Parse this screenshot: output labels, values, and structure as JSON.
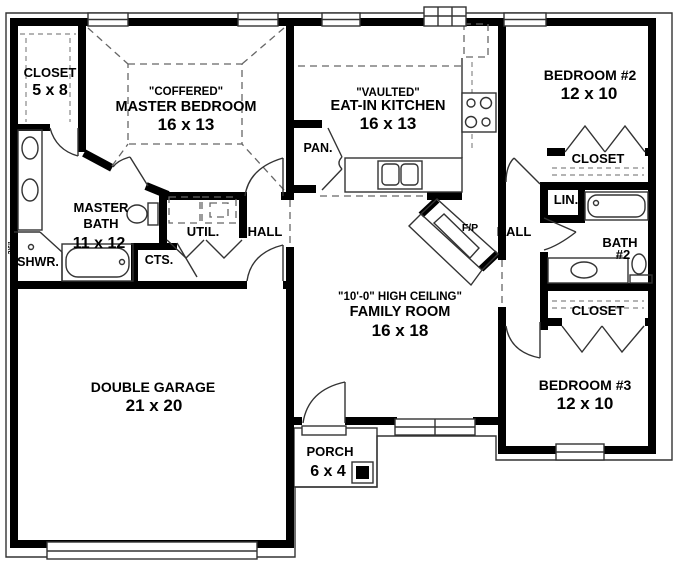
{
  "colors": {
    "walls": "#000000",
    "thin_lines": "#333333",
    "dashed_lines": "#777777",
    "background": "#ffffff"
  },
  "rooms": {
    "master_closet": {
      "name": "CLOSET",
      "dims": "5 x 8"
    },
    "master_bedroom": {
      "ceiling": "\"COFFERED\"",
      "name": "MASTER BEDROOM",
      "dims": "16 x 13"
    },
    "kitchen": {
      "ceiling": "\"VAULTED\"",
      "name": "EAT-IN KITCHEN",
      "dims": "16 x 13"
    },
    "bedroom_2": {
      "name": "BEDROOM #2",
      "dims": "12 x 10"
    },
    "bedroom_2_closet": {
      "name": "CLOSET"
    },
    "linen": {
      "name": "LIN."
    },
    "bath_2": {
      "name": "BATH",
      "number": "#2"
    },
    "bedroom_3_closet": {
      "name": "CLOSET"
    },
    "bedroom_3": {
      "name": "BEDROOM #3",
      "dims": "12 x 10"
    },
    "pantry": {
      "name": "PAN."
    },
    "master_bath": {
      "name_top": "MASTER",
      "name_bottom": "BATH",
      "dims": "11 x 12"
    },
    "shower": {
      "name": "SHWR.",
      "dims": "3'6\""
    },
    "coat_closet": {
      "name": "CTS."
    },
    "utility": {
      "name": "UTIL."
    },
    "hall_west": {
      "name": "HALL"
    },
    "hall_east": {
      "name": "HALL"
    },
    "fireplace": {
      "name": "F/P"
    },
    "family_room": {
      "ceiling": "\"10'-0\" HIGH CEILING\"",
      "name": "FAMILY ROOM",
      "dims": "16 x 18"
    },
    "garage": {
      "name": "DOUBLE GARAGE",
      "dims": "21 x 20"
    },
    "porch": {
      "name": "PORCH",
      "dims": "6 x 4"
    }
  }
}
